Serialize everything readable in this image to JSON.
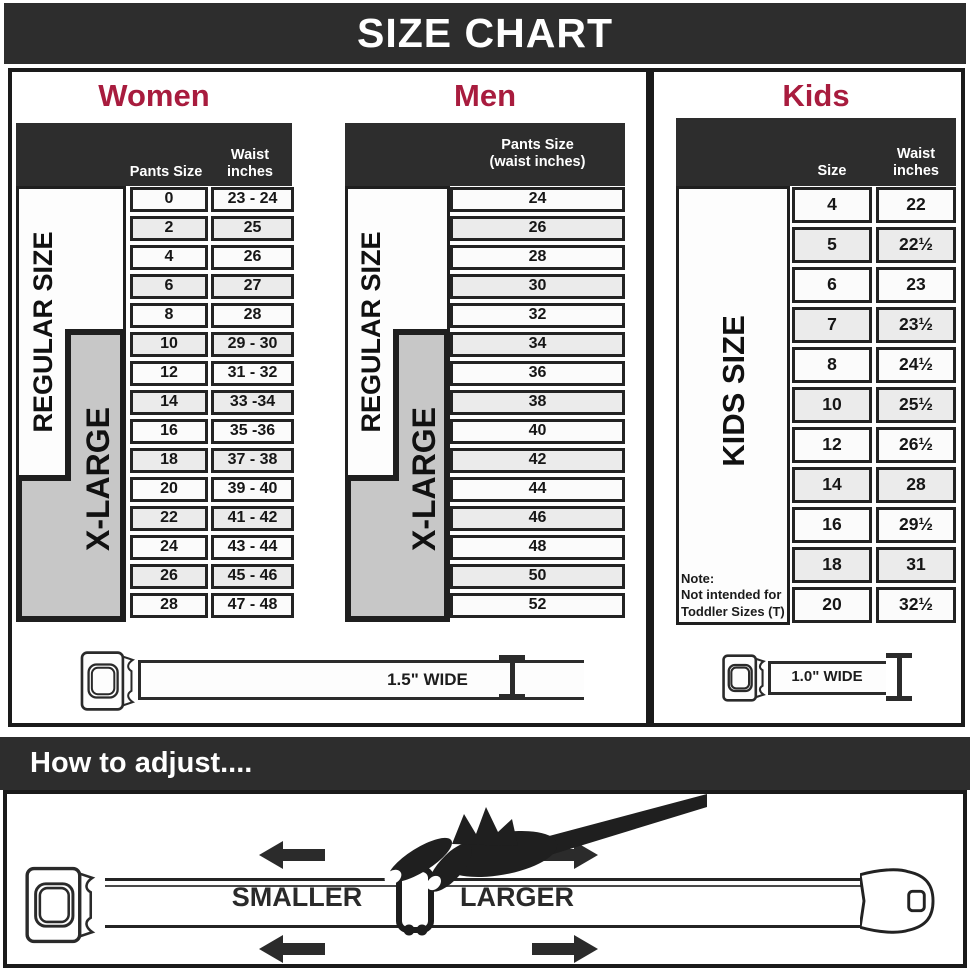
{
  "banner": {
    "title": "SIZE CHART"
  },
  "women": {
    "heading": "Women",
    "pants_header": "Pants Size",
    "waist_header": "Waist\ninches",
    "regular_label": "REGULAR SIZE",
    "xlarge_label": "X-LARGE",
    "rows": [
      {
        "size": "0",
        "waist": "23 - 24"
      },
      {
        "size": "2",
        "waist": "25"
      },
      {
        "size": "4",
        "waist": "26"
      },
      {
        "size": "6",
        "waist": "27"
      },
      {
        "size": "8",
        "waist": "28"
      },
      {
        "size": "10",
        "waist": "29 - 30"
      },
      {
        "size": "12",
        "waist": "31 - 32"
      },
      {
        "size": "14",
        "waist": "33 -34"
      },
      {
        "size": "16",
        "waist": "35 -36"
      },
      {
        "size": "18",
        "waist": "37 - 38"
      },
      {
        "size": "20",
        "waist": "39 - 40"
      },
      {
        "size": "22",
        "waist": "41 - 42"
      },
      {
        "size": "24",
        "waist": "43 - 44"
      },
      {
        "size": "26",
        "waist": "45 - 46"
      },
      {
        "size": "28",
        "waist": "47 - 48"
      }
    ]
  },
  "men": {
    "heading": "Men",
    "col_header": "Pants Size\n(waist inches)",
    "regular_label": "REGULAR SIZE",
    "xlarge_label": "X-LARGE",
    "rows": [
      "24",
      "26",
      "28",
      "30",
      "32",
      "34",
      "36",
      "38",
      "40",
      "42",
      "44",
      "46",
      "48",
      "50",
      "52"
    ]
  },
  "kids": {
    "heading": "Kids",
    "size_header": "Size",
    "waist_header": "Waist\ninches",
    "label": "KIDS SIZE",
    "note": "Note:\nNot intended for\nToddler Sizes (T)",
    "rows": [
      {
        "size": "4",
        "waist": "22"
      },
      {
        "size": "5",
        "waist": "22½"
      },
      {
        "size": "6",
        "waist": "23"
      },
      {
        "size": "7",
        "waist": "23½"
      },
      {
        "size": "8",
        "waist": "24½"
      },
      {
        "size": "10",
        "waist": "25½"
      },
      {
        "size": "12",
        "waist": "26½"
      },
      {
        "size": "14",
        "waist": "28"
      },
      {
        "size": "16",
        "waist": "29½"
      },
      {
        "size": "18",
        "waist": "31"
      },
      {
        "size": "20",
        "waist": "32½"
      }
    ]
  },
  "belts": {
    "adult_width": "1.5\" WIDE",
    "kids_width": "1.0\" WIDE"
  },
  "adjust": {
    "heading": "How to adjust....",
    "smaller": "SMALLER",
    "larger": "LARGER"
  },
  "colors": {
    "accent": "#a81c3e",
    "banner": "#2d2d2d",
    "xlarge_bg": "#c7c7c7"
  }
}
